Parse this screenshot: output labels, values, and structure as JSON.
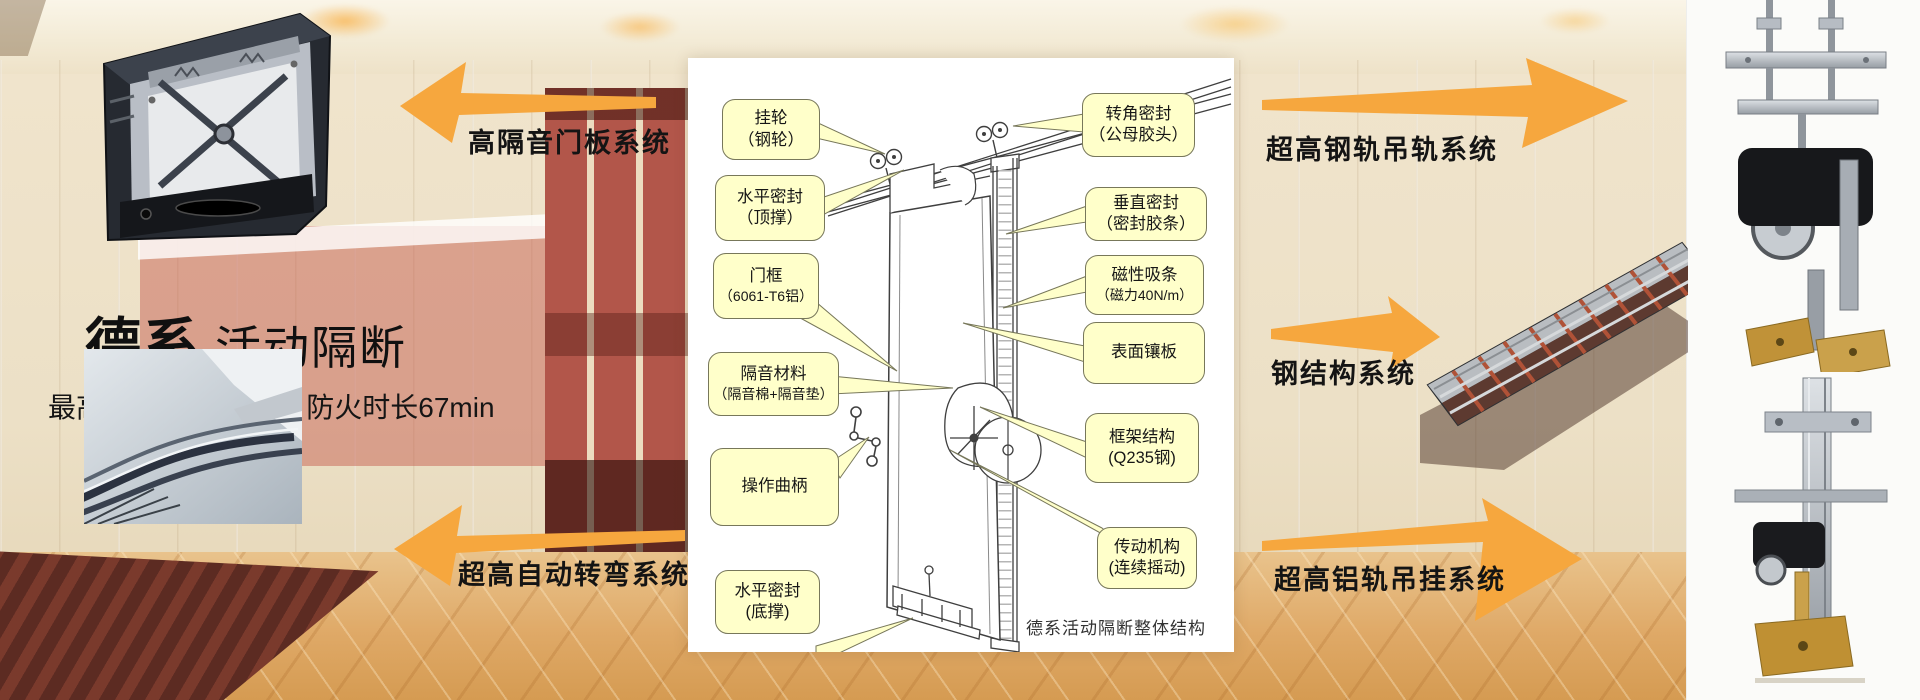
{
  "brand": {
    "series": "德系",
    "product": "活动隔断",
    "specs": "最高隔音系数56db，防火时长67min"
  },
  "systems": {
    "door_panel": "高隔音门板系统",
    "steel_rail": "超高钢轨吊轨系统",
    "steel_structure": "钢结构系统",
    "auto_turn": "超高自动转弯系统",
    "alu_rail": "超高铝轨吊挂系统"
  },
  "diagram": {
    "caption": "德系活动隔断整体结构",
    "callouts_left": [
      {
        "l1": "挂轮",
        "l2": "（钢轮）"
      },
      {
        "l1": "水平密封",
        "l2": "（顶撑）"
      },
      {
        "l1": "门框",
        "l2": "（6061-T6铝）"
      },
      {
        "l1": "隔音材料",
        "l2": "（隔音棉+隔音垫）"
      },
      {
        "l1": "操作曲柄",
        "l2": ""
      },
      {
        "l1": "水平密封",
        "l2": "(底撑)"
      }
    ],
    "callouts_right": [
      {
        "l1": "转角密封",
        "l2": "（公母胶头）"
      },
      {
        "l1": "垂直密封",
        "l2": "（密封胶条）"
      },
      {
        "l1": "磁性吸条",
        "l2": "（磁力40N/m）"
      },
      {
        "l1": "表面镶板",
        "l2": ""
      },
      {
        "l1": "框架结构",
        "l2": "(Q235钢)"
      },
      {
        "l1": "传动机构",
        "l2": "(连续摇动)"
      }
    ]
  },
  "colors": {
    "arrow_orange": "#F6A73E",
    "callout_fill": "#FFFFCA",
    "carpet_tan": "#DFA967",
    "partition_red": "#B2564A"
  }
}
